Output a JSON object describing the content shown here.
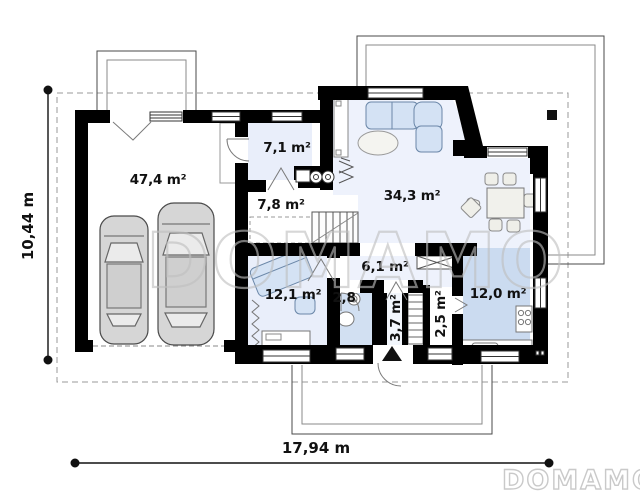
{
  "plan": {
    "rooms": [
      {
        "id": "garage",
        "area_label": "47,4 m²"
      },
      {
        "id": "entry-hall",
        "area_label": "7,1 m²"
      },
      {
        "id": "utility",
        "area_label": "7,8 m²"
      },
      {
        "id": "living-room",
        "area_label": "34,3 m²"
      },
      {
        "id": "hallway",
        "area_label": "6,1 m²"
      },
      {
        "id": "office",
        "area_label": "12,1 m²"
      },
      {
        "id": "wc",
        "area_label": "2,8"
      },
      {
        "id": "vestibule",
        "area_label": "3,7 m²"
      },
      {
        "id": "pantry",
        "area_label": "2,5 m²"
      },
      {
        "id": "kitchen",
        "area_label": "12,0 m²"
      }
    ],
    "dimensions": {
      "overall_width": "17,94 m",
      "overall_height": "10,44 m"
    },
    "watermark_text": "DOMAMO",
    "logo_text": "DOMAMO",
    "colors": {
      "wall": "#000000",
      "floor_light": "#edf1fb",
      "floor_blue": "#cbdbf0",
      "outline_gray": "#4a4a4a"
    }
  }
}
